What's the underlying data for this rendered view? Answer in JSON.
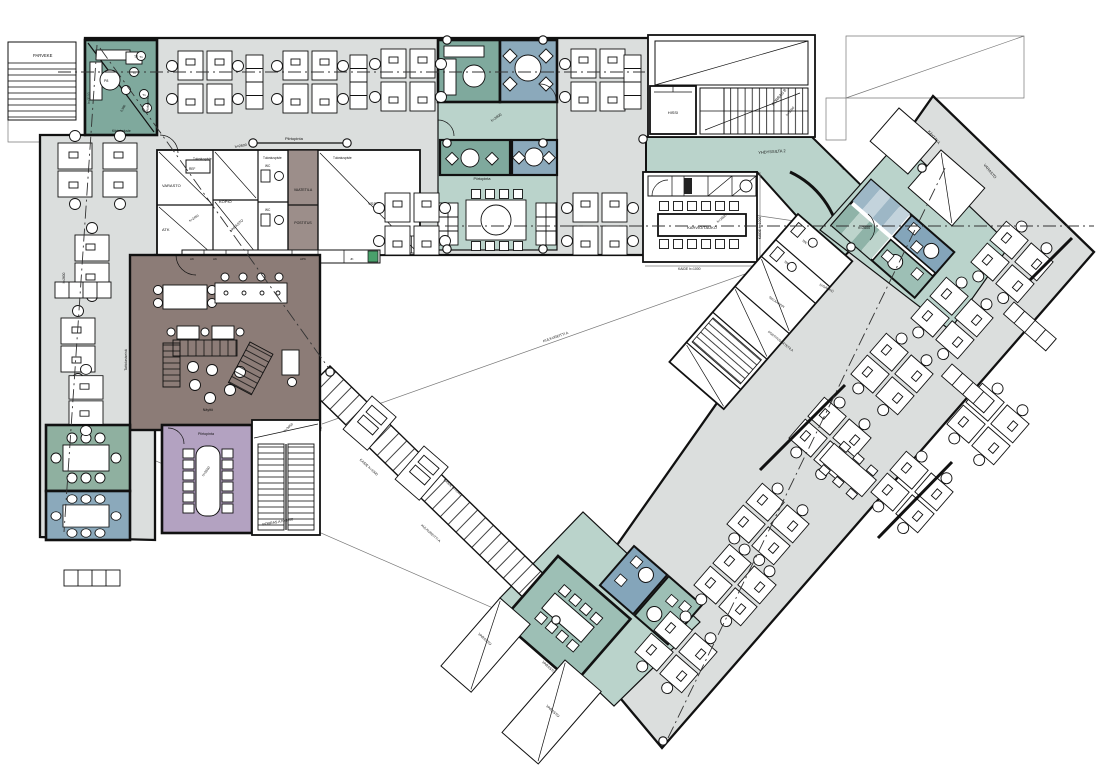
{
  "labels": {
    "parveke": "PARVEKE",
    "kiintokaluste": "Kiintokaluste",
    "h3100": "h=3100",
    "t1": "T1",
    "t2": "T2",
    "p8": "P8",
    "piirtopinta": "Piirtopinta",
    "h2600": "h=2600",
    "h2450": "h=2450",
    "h3050": "h=3050",
    "dim_0980": "0,980",
    "varasto": "VARASTO",
    "ref": "REF",
    "atk": "ATK",
    "kopio": "KOPIO",
    "vaatetila": "VAATETILA",
    "postitus": "POSTITUS",
    "vss": "VSS",
    "tulostuspiste": "Tulostuspiste",
    "ak": "AK",
    "apk": "APK",
    "jk": "JK",
    "wc": "WC",
    "hissi": "HISSI",
    "porras_b": "PORRAS B",
    "kahvio_tauko": "KAHVIO/TAUKO",
    "kaide": "KAIDE h=1000",
    "yhdyssilta_2": "YHDYSSILTA 2",
    "kaytava": "KÄYTÄVÄ",
    "siiv_kaappi": "SIIV.KAAPPI",
    "iv_sahko": "IV/SÄHKÖ",
    "postitus_jatetila": "POSTITUS/JÄTETILA",
    "porras_a": "PORRAS A h=3050",
    "naytto": "Näyttö",
    "taittolasiseina": "Taittolasiseinä",
    "kulkureitti": "KULKUREITTI A"
  },
  "colors": {
    "floor": "#dbdedd",
    "teal_dark": "#7fa99d",
    "teal_mid": "#9dbfb5",
    "teal_light": "#bad3cb",
    "blue_room": "#8ba9bb",
    "blue_cell": "#84a5ba",
    "green_room": "#8fb0a0",
    "purple_room": "#b3a2c1",
    "brown_room": "#8c7c77",
    "brown_light": "#9c8e8a",
    "stripe_blue": "#9db7c6",
    "stripe_blue_light": "#c3d3dc",
    "stripe_teal": "#8fb3a8",
    "stripe_teal_light": "#bdd4cc",
    "accent_green": "#49a06b",
    "wall": "#111111"
  }
}
